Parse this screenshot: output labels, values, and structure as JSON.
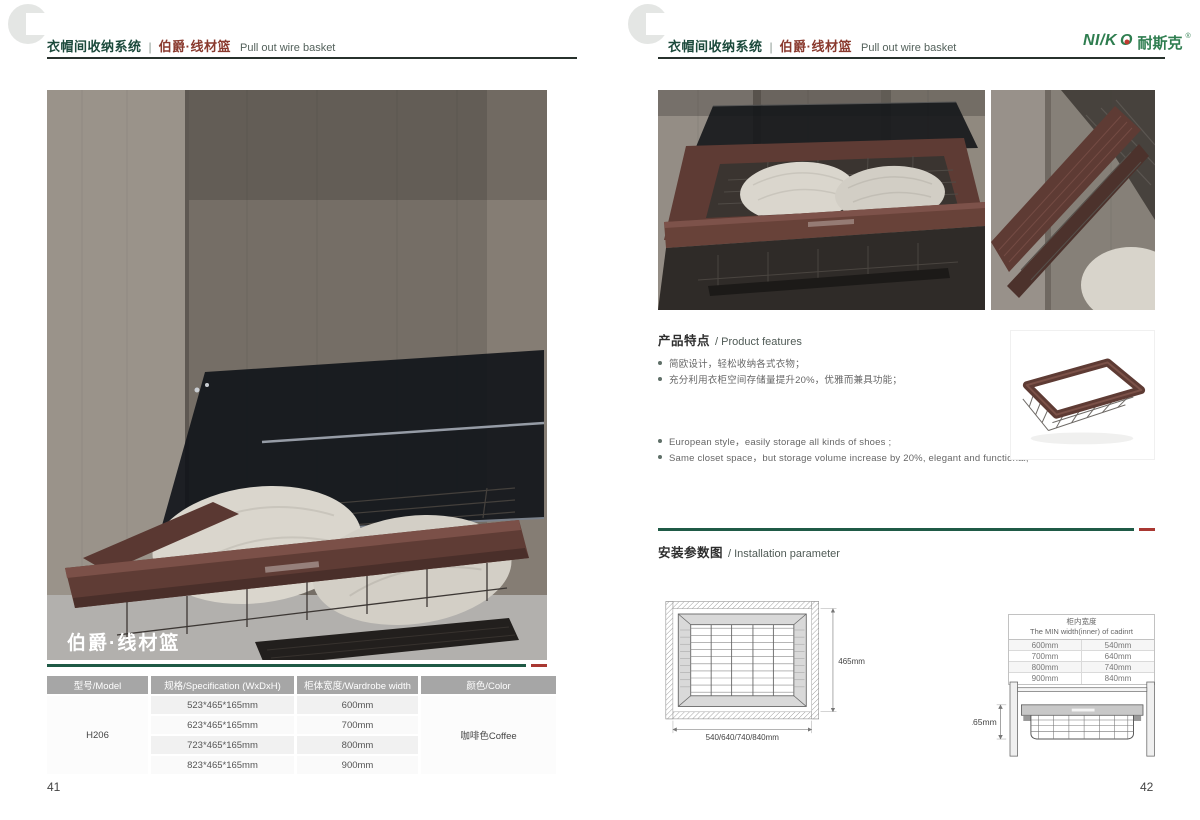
{
  "header": {
    "system_title": "衣帽间收纳系统",
    "separator": "|",
    "product_name": "伯爵·线材篮",
    "product_name_en": "Pull out wire basket"
  },
  "logo": {
    "mark": "NI/K",
    "mark_o": "O",
    "cn": "耐斯克",
    "reg": "®"
  },
  "left_page": {
    "photo_caption": "伯爵·线材篮",
    "page_number": "41",
    "spec_table": {
      "headers": [
        "型号/Model",
        "规格/Specification (WxDxH)",
        "柜体宽度/Wardrobe width",
        "颜色/Color"
      ],
      "model": "H206",
      "color": "咖啡色Coffee",
      "rows": [
        {
          "spec": "523*465*165mm",
          "width": "600mm"
        },
        {
          "spec": "623*465*165mm",
          "width": "700mm"
        },
        {
          "spec": "723*465*165mm",
          "width": "800mm"
        },
        {
          "spec": "823*465*165mm",
          "width": "900mm"
        }
      ]
    }
  },
  "right_page": {
    "page_number": "42",
    "features": {
      "title_cn": "产品特点",
      "title_en": "/ Product features",
      "bullets_cn": [
        "简欧设计，轻松收纳各式衣物；",
        "充分利用衣柜空间存储量提升20%，优雅而兼具功能；"
      ],
      "bullets_en": [
        "European style，easily storage all kinds of shoes ;",
        "Same closet space，but storage volume increase by 20%, elegant and functional;"
      ]
    },
    "installation": {
      "title_cn": "安装参数图",
      "title_en": "/ Installation parameter",
      "top_view": {
        "depth_label": "465mm",
        "width_label": "540/640/740/840mm"
      },
      "min_width_table": {
        "title_cn": "柜内宽度",
        "title_en": "The MIN width(inner) of cadinrt",
        "rows": [
          [
            "600mm",
            "540mm"
          ],
          [
            "700mm",
            "640mm"
          ],
          [
            "800mm",
            "740mm"
          ],
          [
            "900mm",
            "840mm"
          ]
        ]
      },
      "side_view": {
        "height_label": "165mm"
      }
    }
  },
  "colors": {
    "brand_green": "#2e7d4f",
    "header_green": "#1c4a3c",
    "product_red": "#8a3a2e",
    "divider_green": "#1f5a46",
    "accent_red": "#a93832",
    "coffee_frame": "#5e3b34",
    "table_header_bg": "#a6a6a6"
  }
}
